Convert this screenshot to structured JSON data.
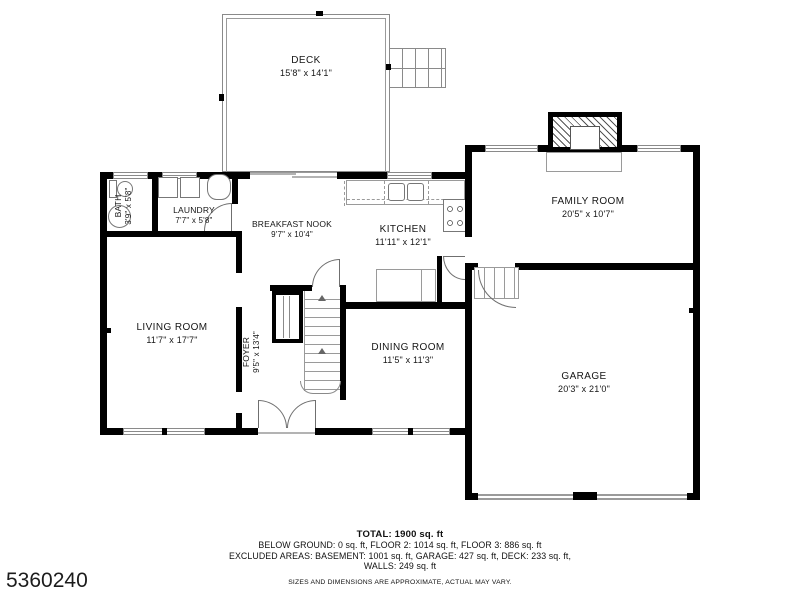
{
  "listing_id": "5360240",
  "rooms": {
    "deck": {
      "name": "DECK",
      "dims": "15'8\" x 14'1\""
    },
    "bath": {
      "name": "BATH",
      "dims": "3'9\" x 5'8\""
    },
    "laundry": {
      "name": "LAUNDRY",
      "dims": "7'7\" x 5'8\""
    },
    "breakfast_nook": {
      "name": "BREAKFAST NOOK",
      "dims": "9'7\" x 10'4\""
    },
    "kitchen": {
      "name": "KITCHEN",
      "dims": "11'11\" x 12'1\""
    },
    "family_room": {
      "name": "FAMILY ROOM",
      "dims": "20'5\" x 10'7\""
    },
    "living_room": {
      "name": "LIVING ROOM",
      "dims": "11'7\" x 17'7\""
    },
    "foyer": {
      "name": "FOYER",
      "dims": "9'5\" x 13'4\""
    },
    "dining_room": {
      "name": "DINING ROOM",
      "dims": "11'5\" x 11'3\""
    },
    "garage": {
      "name": "GARAGE",
      "dims": "20'3\" x 21'0\""
    }
  },
  "summary": {
    "total": "TOTAL: 1900 sq. ft",
    "line2": "BELOW GROUND: 0 sq. ft, FLOOR 2: 1014 sq. ft, FLOOR 3: 886 sq. ft",
    "line3": "EXCLUDED AREAS: BASEMENT: 1001 sq. ft, GARAGE: 427 sq. ft, DECK: 233 sq. ft,",
    "line4": "WALLS: 249 sq. ft",
    "disclaimer": "SIZES AND DIMENSIONS ARE APPROXIMATE, ACTUAL MAY VARY."
  },
  "colors": {
    "wall": "#000000",
    "line": "#8a8a8a",
    "text": "#161616",
    "background": "#ffffff"
  }
}
